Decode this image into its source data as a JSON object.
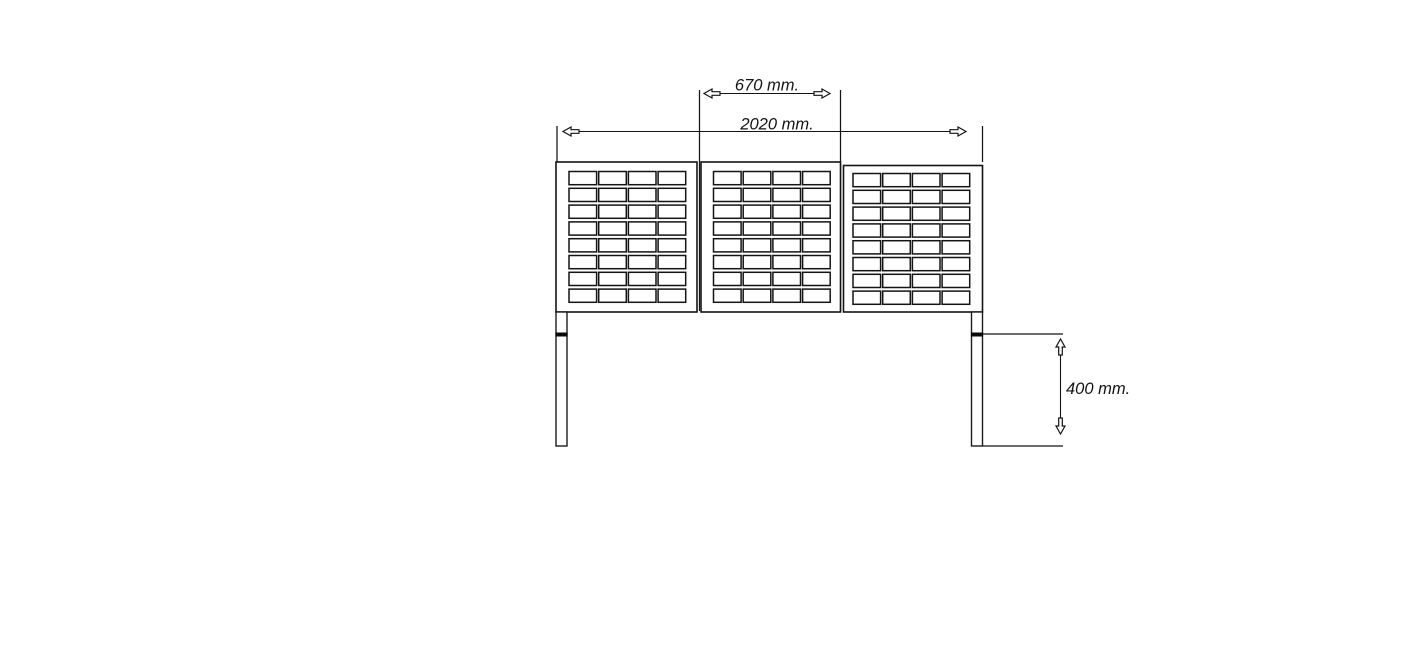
{
  "drawing": {
    "type": "technical-elevation-drawing",
    "background_color": "#ffffff",
    "line_color": "#141414",
    "dimensions": {
      "panel_width": {
        "label": "670 mm.",
        "value": 670,
        "unit": "mm"
      },
      "total_width": {
        "label": "2020 mm.",
        "value": 2020,
        "unit": "mm"
      },
      "leg_height": {
        "label": "400 mm.",
        "value": 400,
        "unit": "mm"
      }
    },
    "panels": {
      "count": 3,
      "grid": {
        "rows": 8,
        "cols": 4
      }
    },
    "legs": {
      "count": 2
    }
  }
}
